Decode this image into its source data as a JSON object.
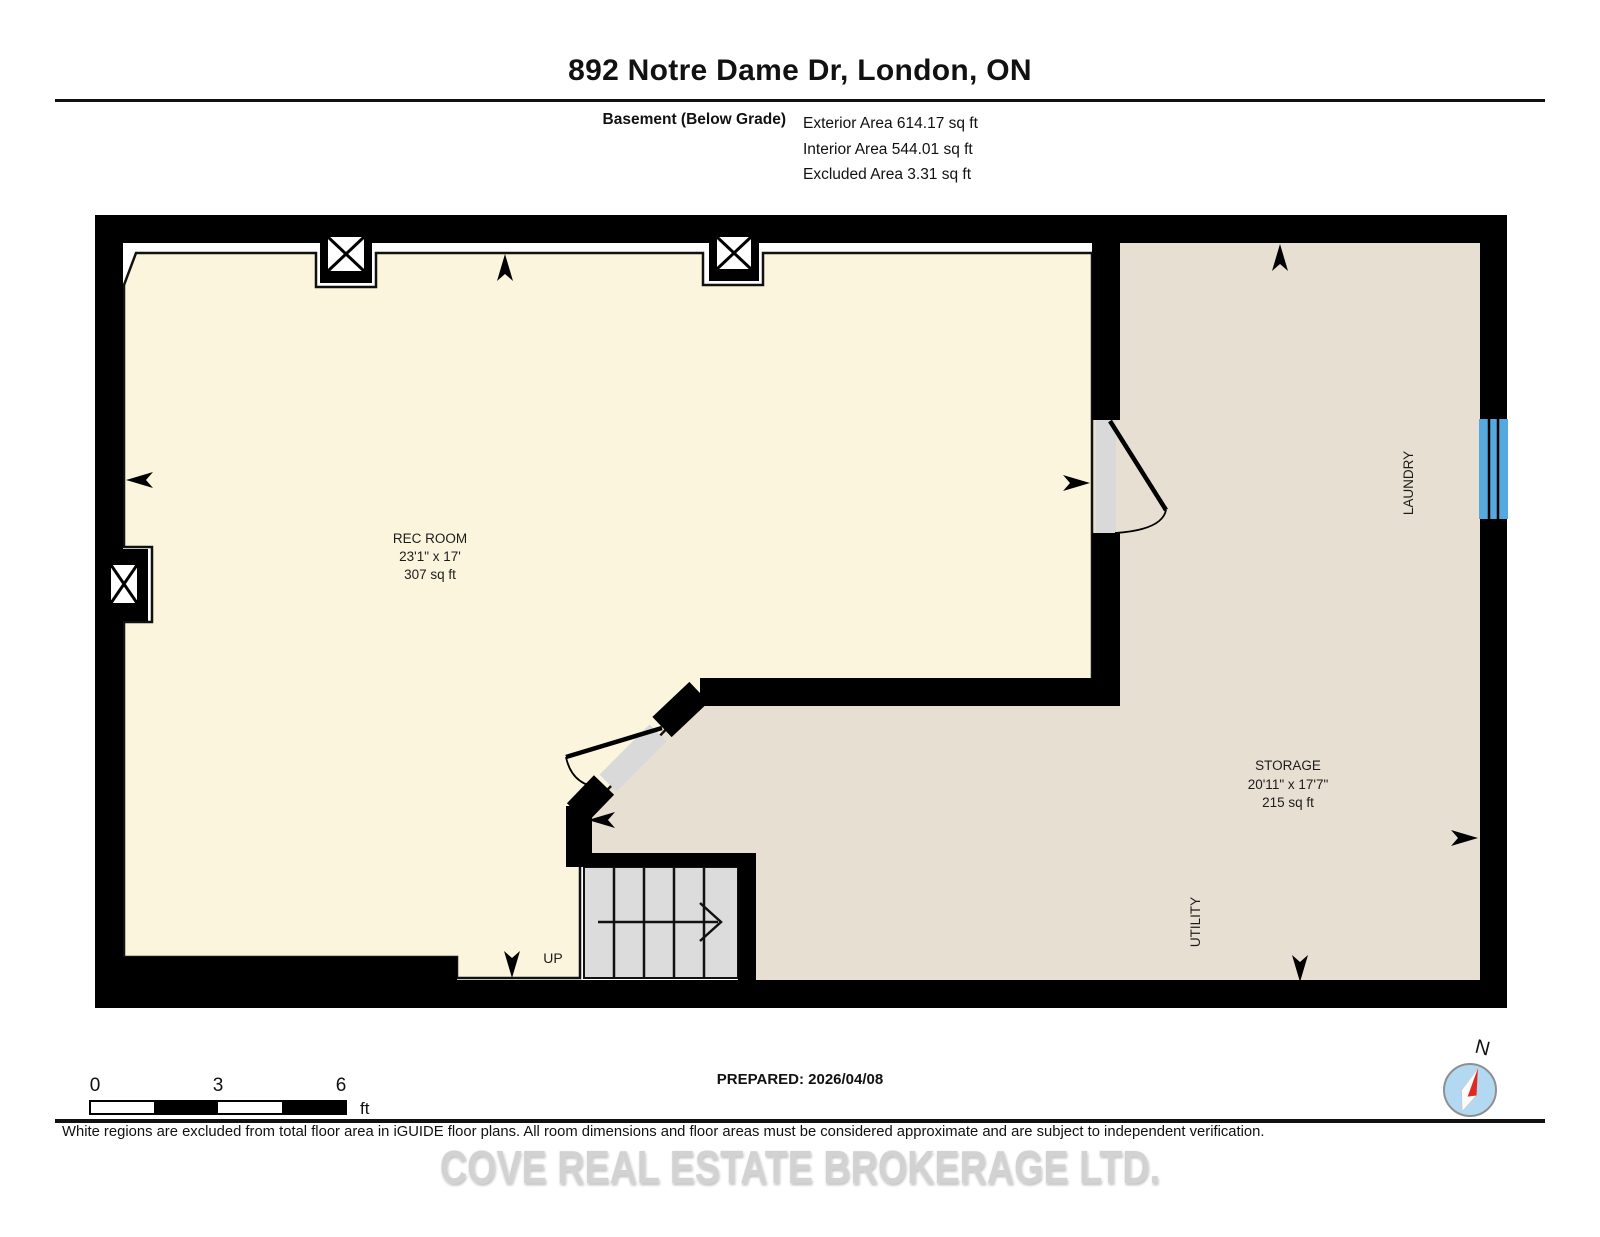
{
  "header": {
    "title": "892 Notre Dame Dr, London, ON",
    "floor_label": "Basement (Below Grade)",
    "areas": [
      "Exterior Area 614.17 sq ft",
      "Interior Area 544.01 sq ft",
      "Excluded Area 3.31 sq ft"
    ]
  },
  "plan": {
    "rec_room": {
      "name": "REC ROOM",
      "dims": "23'1\" x 17'",
      "area": "307 sq ft"
    },
    "storage": {
      "name": "STORAGE",
      "dims": "20'11\" x 17'7\"",
      "area": "215 sq ft"
    },
    "laundry": {
      "name": "LAUNDRY"
    },
    "utility": {
      "name": "UTILITY"
    },
    "stairs_label": "UP"
  },
  "scale_bar": {
    "tick0": "0",
    "tick1": "3",
    "tick2": "6",
    "unit": "ft"
  },
  "compass_label": "N",
  "prepared_label": "PREPARED: 2026/04/08",
  "footer": {
    "disclaimer": "White regions are excluded from total floor area in iGUIDE floor plans. All room dimensions and floor areas must be considered approximate and are subject to independent verification.",
    "watermark": "COVE REAL ESTATE BROKERAGE LTD."
  },
  "colors": {
    "wall": "#000000",
    "rec_room_fill": "#FBF5DE",
    "storage_fill": "#E7DFD2",
    "stairs_fill": "#DCDCDC",
    "window": "#55A9DE",
    "compass_disc": "#B3D9F2",
    "compass_needle": "#DD2B23"
  }
}
